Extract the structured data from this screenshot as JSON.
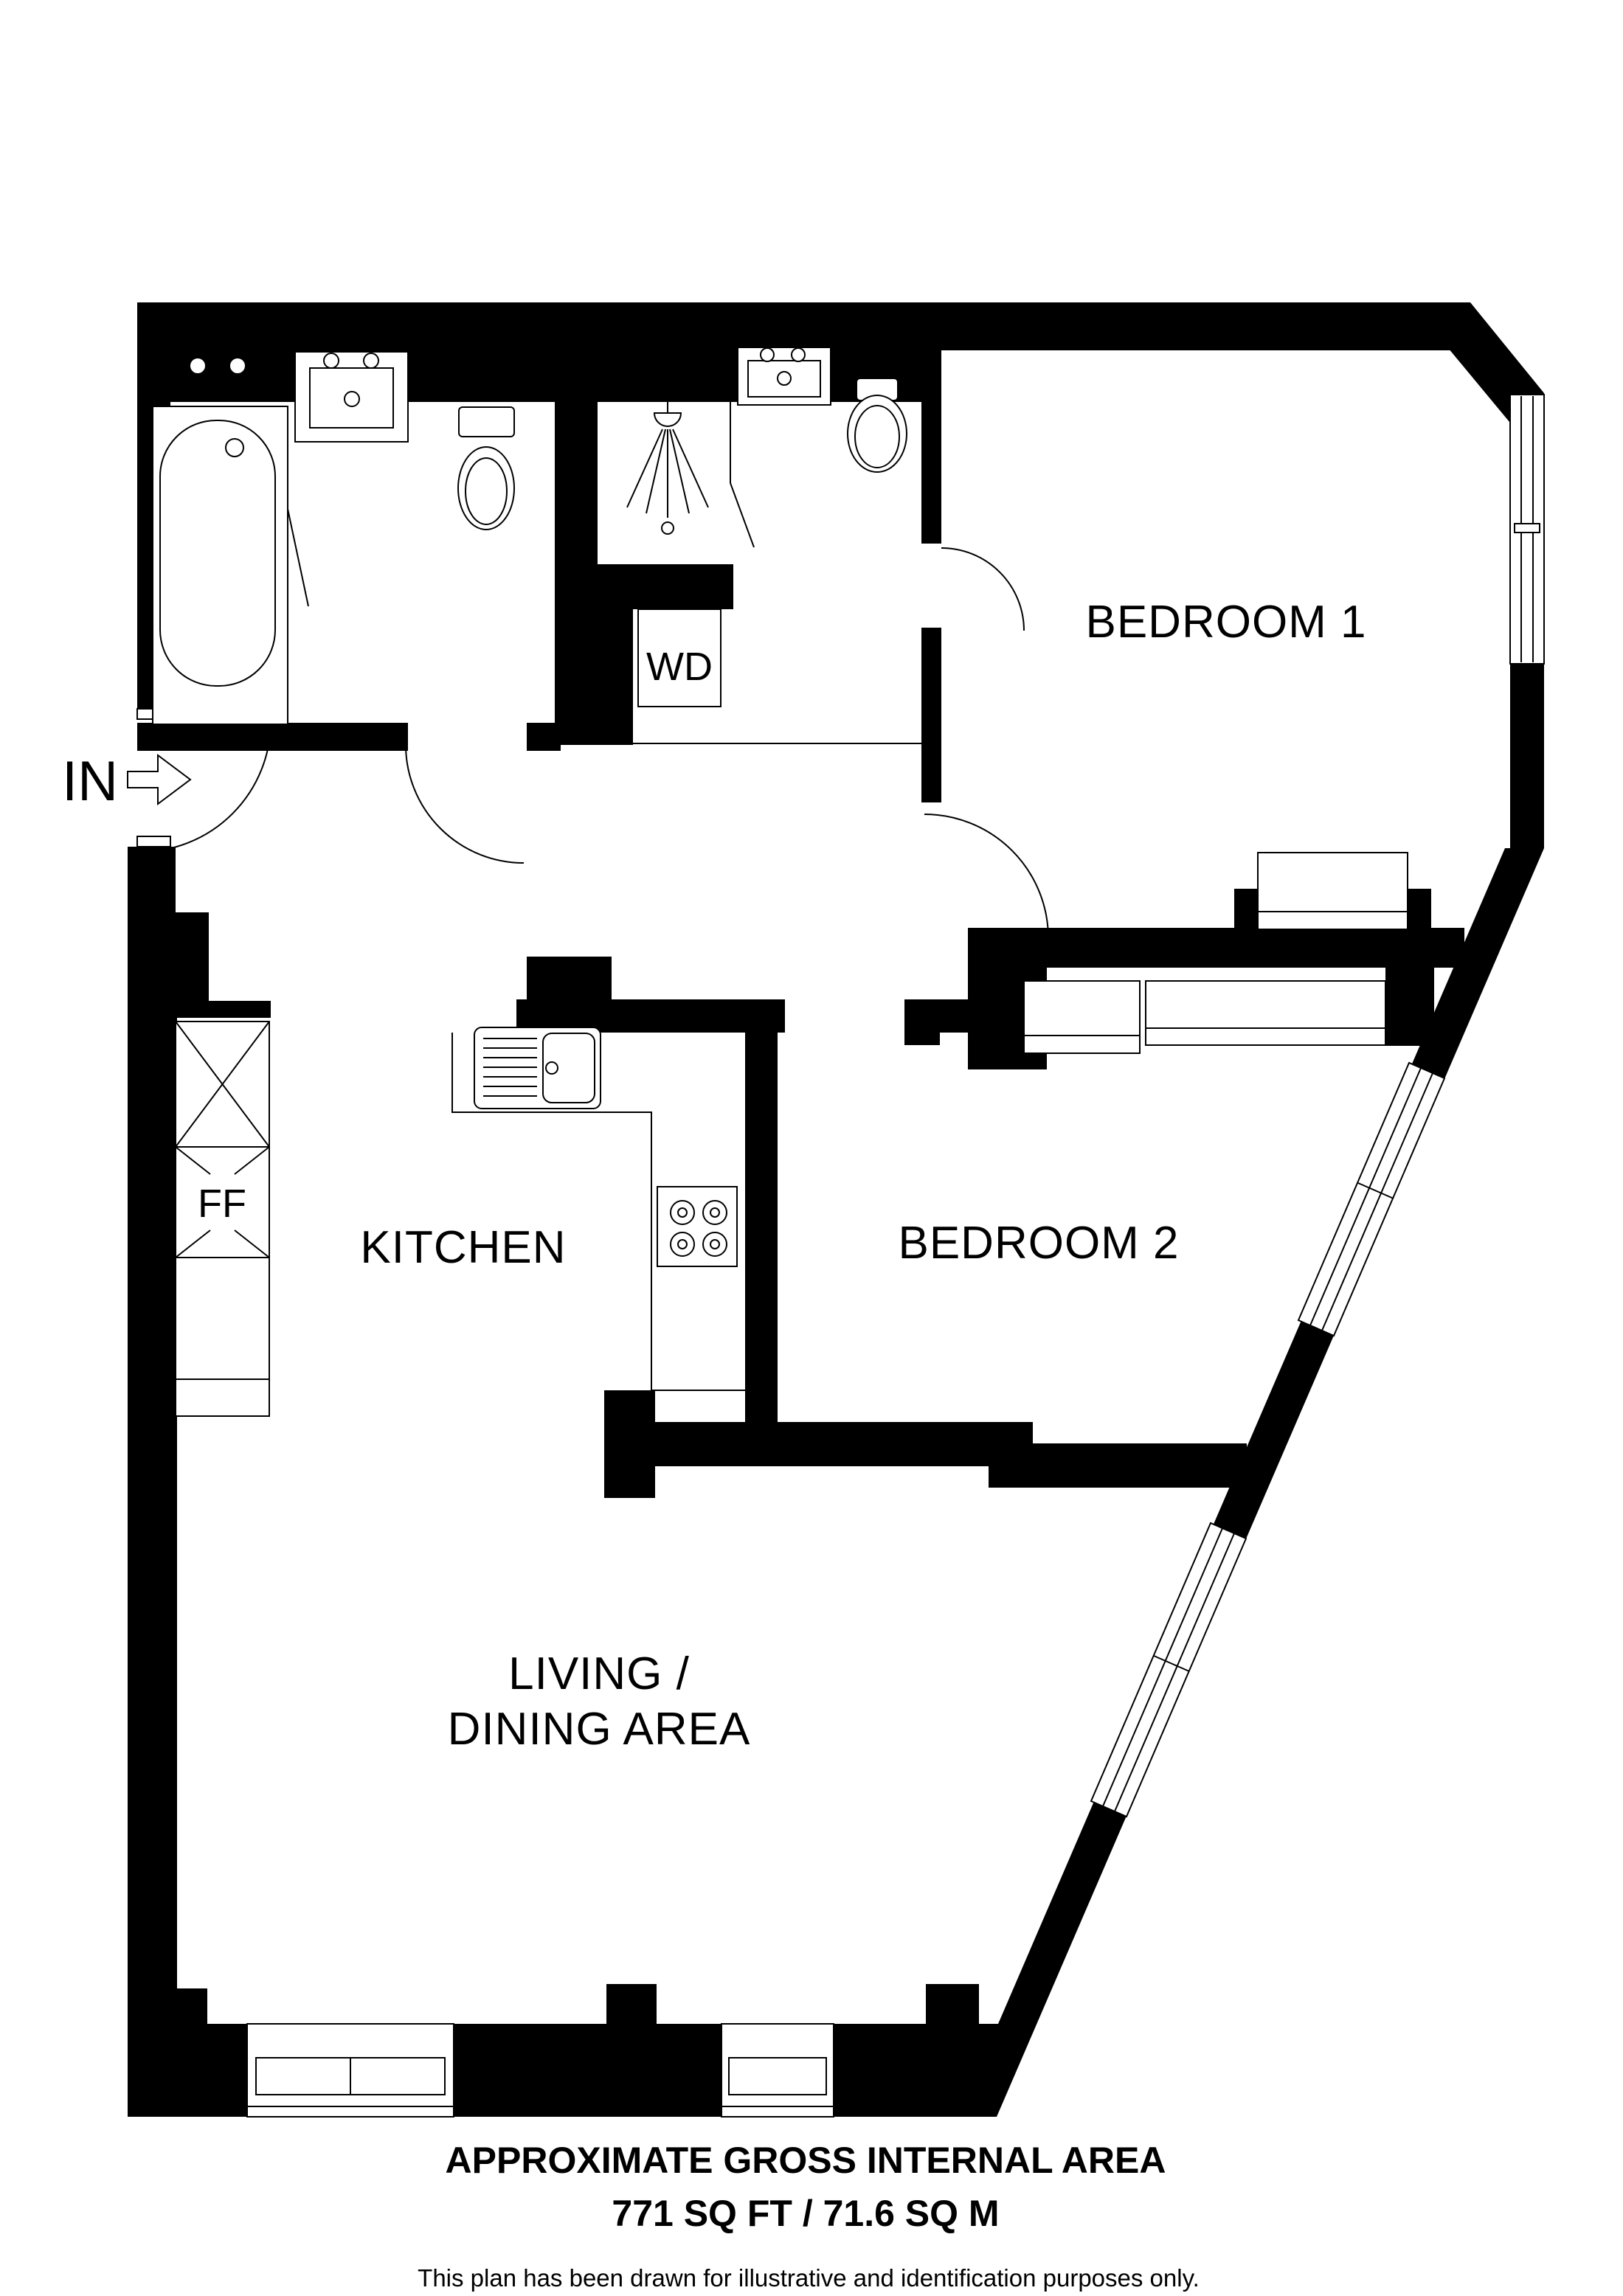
{
  "colors": {
    "wall": "#000000",
    "background": "#ffffff"
  },
  "rooms": {
    "bedroom1": {
      "label": "BEDROOM 1"
    },
    "bedroom2": {
      "label": "BEDROOM 2"
    },
    "kitchen": {
      "label": "KITCHEN"
    },
    "living_dining": {
      "label_line1": "LIVING /",
      "label_line2": "DINING AREA"
    }
  },
  "units": {
    "washer_dryer": {
      "label": "WD"
    },
    "fridge_freezer": {
      "label": "FF"
    },
    "entrance": {
      "label": "IN"
    }
  },
  "footer": {
    "area_title": "APPROXIMATE GROSS INTERNAL AREA",
    "area_value": "771 SQ FT / 71.6 SQ M",
    "disclaimer": "This plan has been drawn for illustrative and identification purposes only."
  }
}
